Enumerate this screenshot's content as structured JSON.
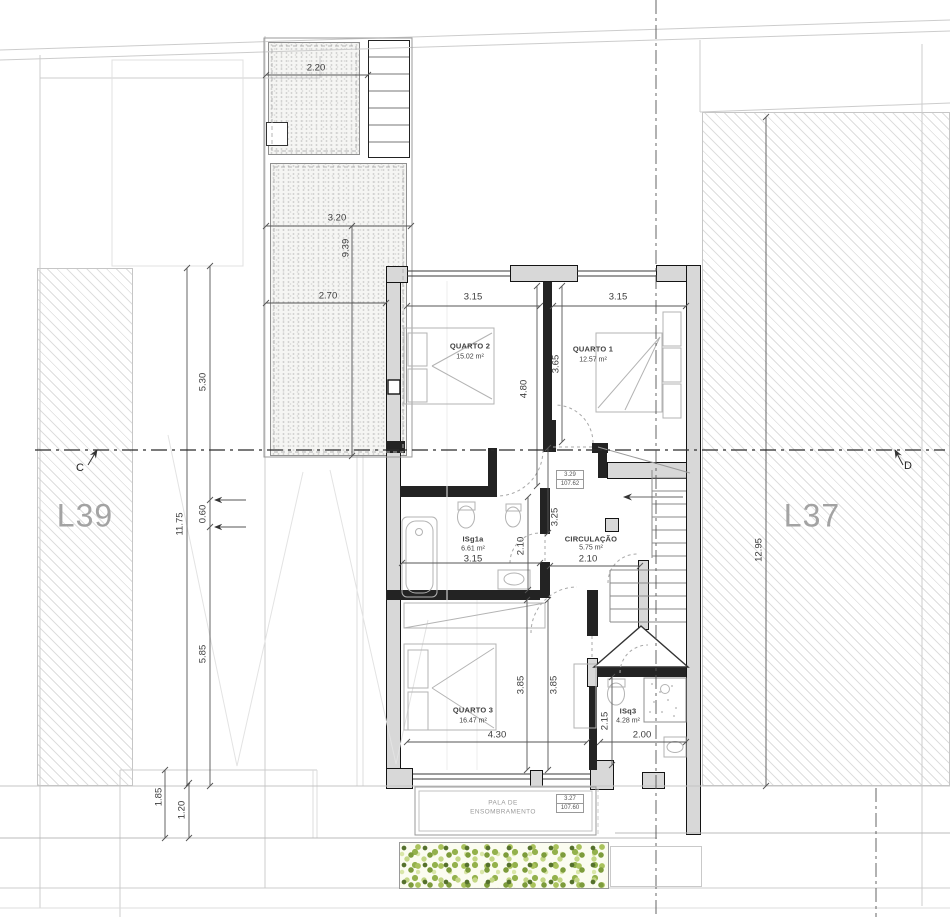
{
  "lots": {
    "left": "L39",
    "right": "L37"
  },
  "section_markers": {
    "left": "C",
    "right": "D"
  },
  "rooms": {
    "quarto2": {
      "name": "QUARTO 2",
      "area": "15.02 m²"
    },
    "quarto1": {
      "name": "QUARTO 1",
      "area": "12.57 m²"
    },
    "isg1a": {
      "name": "ISg1a",
      "area": "6.61 m²"
    },
    "circulacao": {
      "name": "CIRCULAÇÃO",
      "area": "5.75 m²"
    },
    "quarto3": {
      "name": "QUARTO 3",
      "area": "16.47 m²"
    },
    "isq3": {
      "name": "ISq3",
      "area": "4.28 m²"
    }
  },
  "levels": {
    "floor": {
      "relative": "3.29",
      "absolute": "107.62"
    },
    "canopy": {
      "relative": "3.27",
      "absolute": "107.60"
    }
  },
  "canopy_label": {
    "line1": "PALA DE",
    "line2": "ENSOMBRAMENTO"
  },
  "dimensions": {
    "terrace_width_top": "2.20",
    "terrace_width_mid": "3.20",
    "terrace_length": "9.39",
    "terrace_width_low": "2.70",
    "left_upper": "5.30",
    "left_small": "0.60",
    "left_total": "11.75",
    "left_lower": "5.85",
    "left_bottom_a": "1.85",
    "left_bottom_b": "1.20",
    "quarto2_width": "3.15",
    "quarto1_width": "3.15",
    "quarto2_depth": "4.80",
    "quarto1_depth": "3.65",
    "circ_depth": "3.25",
    "isg1a_depth": "2.10",
    "isg1a_width": "3.15",
    "circ_width": "2.10",
    "quarto3_depth_a": "3.85",
    "quarto3_depth_b": "3.85",
    "quarto3_width": "4.30",
    "isq3_depth": "2.15",
    "isq3_width": "2.00",
    "right_lot_depth": "12.95"
  },
  "colors": {
    "wall_fill": "#d8d8d8",
    "wall_line": "#141414",
    "hedge_green": "#93b14c",
    "lot_label_gray": "#a3a3a3"
  }
}
